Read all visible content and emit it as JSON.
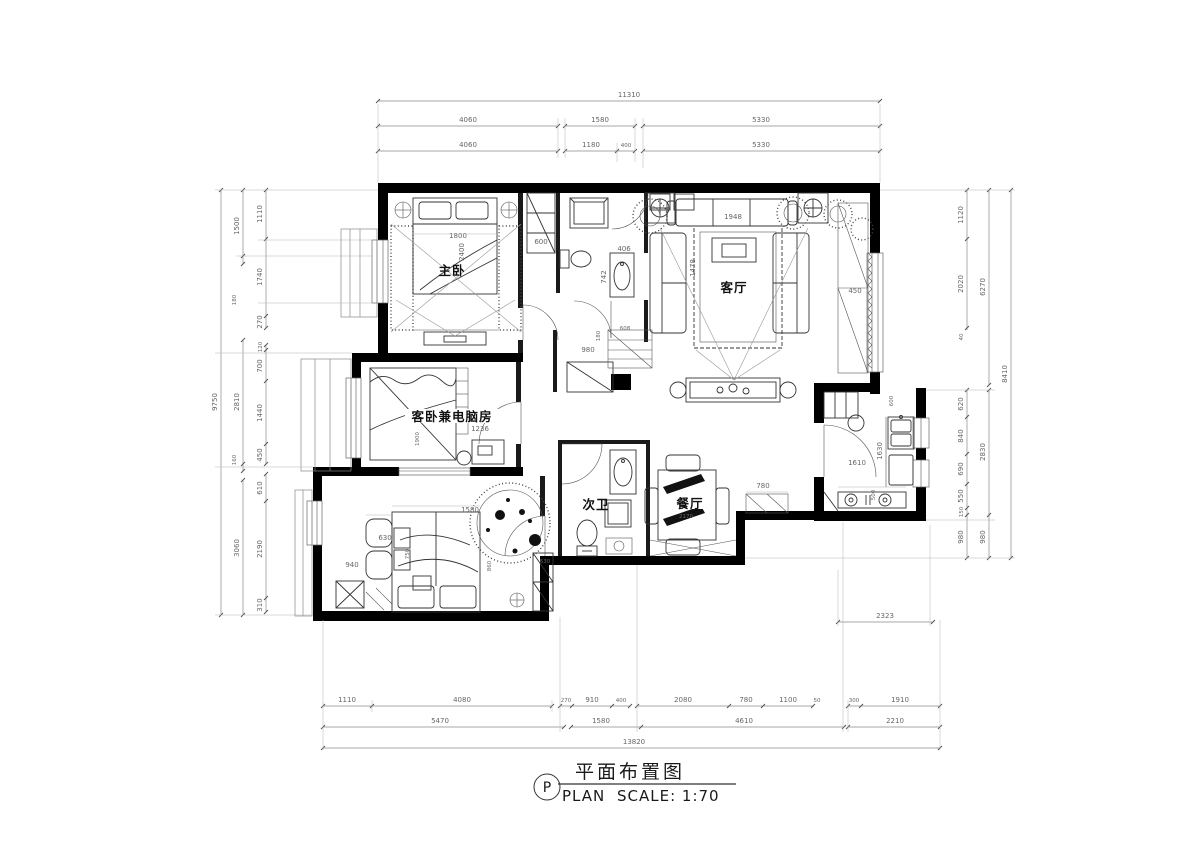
{
  "title_block": {
    "letter": "P",
    "title": "平面布置图",
    "plan_label": "PLAN",
    "scale_label": "SCALE: 1:70"
  },
  "rooms": {
    "master_bedroom": "主卧",
    "living_room": "客厅",
    "guest_bedroom": "客卧兼电脑房",
    "second_bathroom": "次卫",
    "dining_room": "餐厅"
  },
  "colors": {
    "wall": "#000000",
    "line": "#333333",
    "dim": "#666666"
  },
  "dims": {
    "top": {
      "total": "11310",
      "row2": [
        "4060",
        "1580",
        "5330"
      ],
      "row3": [
        "4060",
        "1180",
        "400",
        "5330"
      ]
    },
    "bottom": {
      "row1": [
        "1110",
        "4080",
        "270",
        "910",
        "400",
        "2080",
        "780",
        "1100",
        "50",
        "300",
        "1910"
      ],
      "row2": [
        "5470",
        "1580",
        "4610",
        "2210"
      ],
      "total": "13820"
    },
    "left": {
      "inner": [
        "1110",
        "1740",
        "270",
        "120",
        "700",
        "1440",
        "450",
        "610",
        "2190",
        "310"
      ],
      "mid": [
        "1500",
        "180",
        "2810",
        "160",
        "3060"
      ],
      "total": "9750"
    },
    "right": {
      "inner": [
        "1120",
        "2020",
        "40",
        "620",
        "840",
        "690",
        "550",
        "150",
        "980"
      ],
      "mid": [
        "6270",
        "2830",
        "980"
      ],
      "total": "8410",
      "annex": "2323"
    },
    "interior": {
      "master_bed_w": "1800",
      "master_bed_d": "2400",
      "closet_w": "600",
      "sink_w": "406",
      "sink_d": "742",
      "hall_w": "980",
      "hall_niche": "180",
      "hall_d": "608",
      "sofa_w": "1948",
      "rug_d": "1478",
      "living_win": "450",
      "desk_w": "1236",
      "guest_bed_d": "1900",
      "bed3_w": "1580",
      "chair_w": "630",
      "chair_d": "750",
      "bed3_left": "940",
      "bed3_right": "860",
      "closet3_w": "630",
      "kitchen_w": "1610",
      "kitchen_d": "1630",
      "counter_w": "600",
      "stove_d": "500",
      "dining_clear": "780",
      "dining_w": "2170"
    }
  }
}
